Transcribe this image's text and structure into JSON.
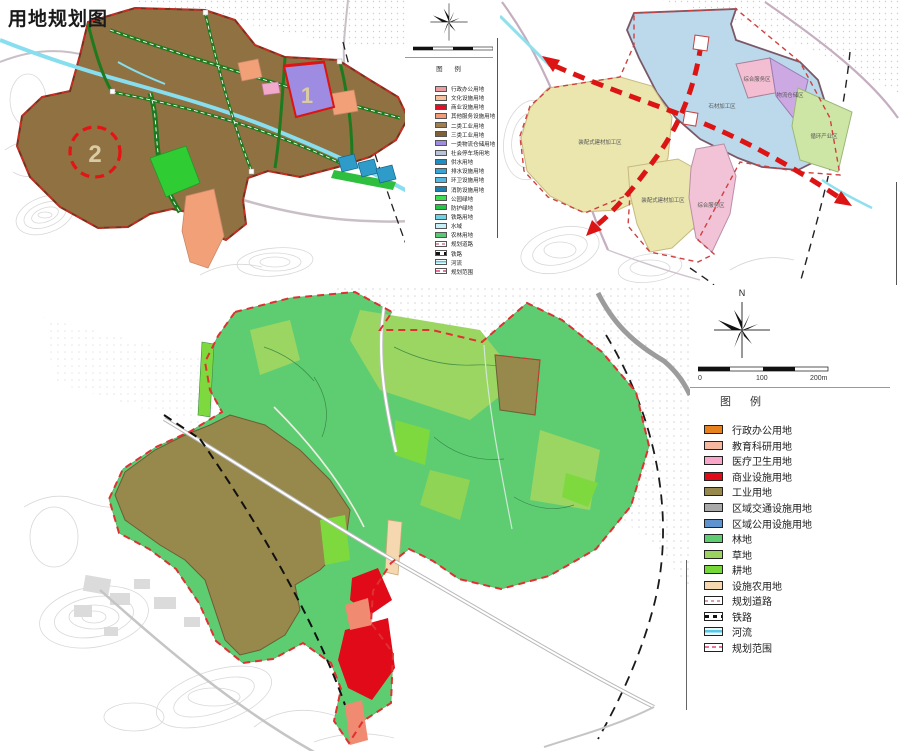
{
  "title": "用地规划图",
  "colors": {
    "planning_boundary": "#E03030",
    "corridor_red": "#DC1414",
    "river": "#8FE0EE",
    "industrial_brown": "#97884C",
    "forest_green": "#5ECD72"
  },
  "panel_top_left": {
    "markers": {
      "m1": "1",
      "m2": "2"
    },
    "legend": {
      "title": "图  例",
      "items": [
        {
          "label": "行政办公用地",
          "kind": "fill",
          "color": "#EC9DA2"
        },
        {
          "label": "文化设施用地",
          "kind": "fill",
          "color": "#F6C09E"
        },
        {
          "label": "商业设施用地",
          "kind": "fill",
          "color": "#E20F26"
        },
        {
          "label": "其他服务设施用地",
          "kind": "fill",
          "color": "#F29B76"
        },
        {
          "label": "二类工业用地",
          "kind": "fill",
          "color": "#A07E4E"
        },
        {
          "label": "三类工业用地",
          "kind": "fill",
          "color": "#7F6134"
        },
        {
          "label": "一类物流仓储用地",
          "kind": "fill",
          "color": "#9D8CE2"
        },
        {
          "label": "社会停车场用地",
          "kind": "fill",
          "color": "#B7C3D6"
        },
        {
          "label": "供水用地",
          "kind": "fill",
          "color": "#1E8FC6"
        },
        {
          "label": "排水设施用地",
          "kind": "fill",
          "color": "#35A5D8"
        },
        {
          "label": "环卫设施用地",
          "kind": "fill",
          "color": "#54B8E0"
        },
        {
          "label": "消防设施用地",
          "kind": "fill",
          "color": "#1B7FB2"
        },
        {
          "label": "公园绿地",
          "kind": "fill",
          "color": "#3EDE52"
        },
        {
          "label": "防护绿地",
          "kind": "fill",
          "color": "#25C348"
        },
        {
          "label": "铁路用地",
          "kind": "fill",
          "color": "#6FD3E6"
        },
        {
          "label": "水域",
          "kind": "fill",
          "color": "#C6F0F8"
        },
        {
          "label": "农林用地",
          "kind": "fill",
          "color": "#58C973"
        },
        {
          "label": "规划道路",
          "kind": "road"
        },
        {
          "label": "铁路",
          "kind": "rail"
        },
        {
          "label": "河流",
          "kind": "river"
        },
        {
          "label": "规划范围",
          "kind": "boundary"
        }
      ]
    }
  },
  "panel_top_right": {
    "zones": [
      {
        "label": "石材加工区",
        "color": "#BBD9EB"
      },
      {
        "label": "装配式建材加工区",
        "color": "#EAE6AE"
      },
      {
        "label": "装配式建材加工区",
        "color": "#EAE6AE"
      },
      {
        "label": "综合服务区",
        "color": "#F4BED2"
      },
      {
        "label": "物流仓储区",
        "color": "#CDA9E4"
      },
      {
        "label": "循环产业区",
        "color": "#CDE6A5"
      },
      {
        "label": "综合服务区",
        "color": "#F2C3D6"
      }
    ]
  },
  "panel_bottom": {
    "compass_n": "N",
    "legend": {
      "title": "图  例",
      "scale_labels": [
        "0",
        "100",
        "200m"
      ],
      "items": [
        {
          "label": "行政办公用地",
          "kind": "fill",
          "color": "#E5821E"
        },
        {
          "label": "教育科研用地",
          "kind": "fill",
          "color": "#F5B79F"
        },
        {
          "label": "医疗卫生用地",
          "kind": "fill",
          "color": "#F9A6C9"
        },
        {
          "label": "商业设施用地",
          "kind": "fill",
          "color": "#E00A18"
        },
        {
          "label": "工业用地",
          "kind": "fill",
          "color": "#97884C"
        },
        {
          "label": "区域交通设施用地",
          "kind": "fill",
          "color": "#A9A9A9"
        },
        {
          "label": "区域公用设施用地",
          "kind": "fill",
          "color": "#5E93CF"
        },
        {
          "label": "林地",
          "kind": "fill",
          "color": "#5ECD72"
        },
        {
          "label": "草地",
          "kind": "fill",
          "color": "#9AD45F"
        },
        {
          "label": "耕地",
          "kind": "fill",
          "color": "#76D836"
        },
        {
          "label": "设施农用地",
          "kind": "fill",
          "color": "#F5D8AF"
        },
        {
          "label": "规划道路",
          "kind": "road"
        },
        {
          "label": "铁路",
          "kind": "rail"
        },
        {
          "label": "河流",
          "kind": "river"
        },
        {
          "label": "规划范围",
          "kind": "boundary"
        }
      ]
    }
  }
}
